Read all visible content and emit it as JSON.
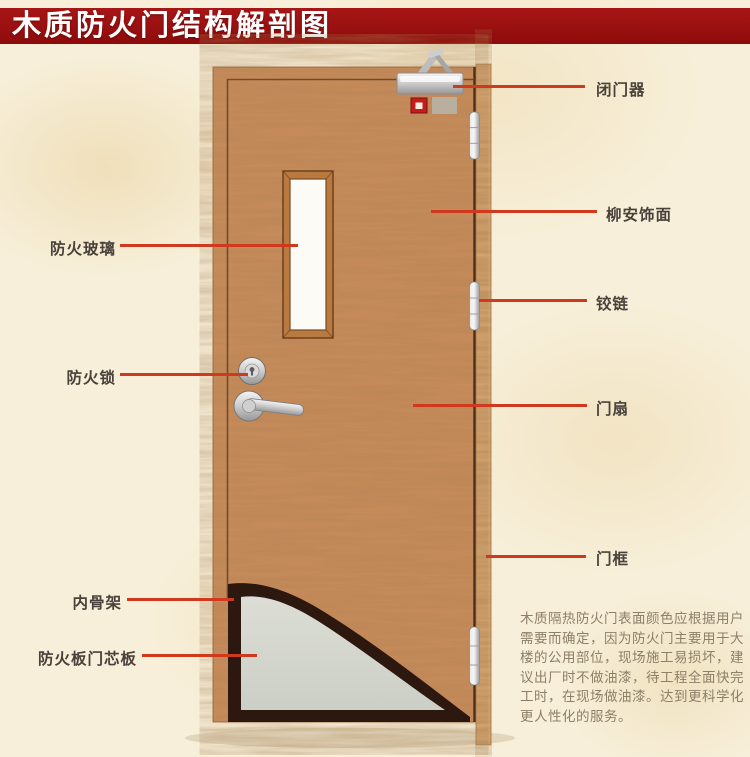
{
  "title": "木质防火门结构解剖图",
  "labels_left": [
    {
      "id": "fire-glass",
      "text": "防火玻璃"
    },
    {
      "id": "fire-lock",
      "text": "防火锁"
    },
    {
      "id": "inner-skeleton",
      "text": "内骨架"
    },
    {
      "id": "fire-board-core",
      "text": "防火板门芯板"
    }
  ],
  "labels_right": [
    {
      "id": "door-closer",
      "text": "闭门器"
    },
    {
      "id": "lauan-veneer",
      "text": "柳安饰面"
    },
    {
      "id": "hinge",
      "text": "铰链"
    },
    {
      "id": "door-leaf",
      "text": "门扇"
    },
    {
      "id": "door-frame",
      "text": "门框"
    }
  ],
  "description_lines": [
    "木质隔热防火门表面颜色应根据用户",
    "需要而确定，因为防火门主要用于大",
    "楼的公用部位，现场施工易损坏，建",
    "议出厂时不做油漆，待工程全面快完",
    "工时，在现场做油漆。达到更科学化",
    "更人性化的服务。"
  ],
  "colors": {
    "banner_red": "#9a0f0f",
    "leader_line_red": "#cf3a1f",
    "door_wood": "#c98c5b",
    "frame_wood": "#d9a873",
    "core_gray": "#d6d8d0",
    "skeleton_dark": "#2d1810"
  }
}
